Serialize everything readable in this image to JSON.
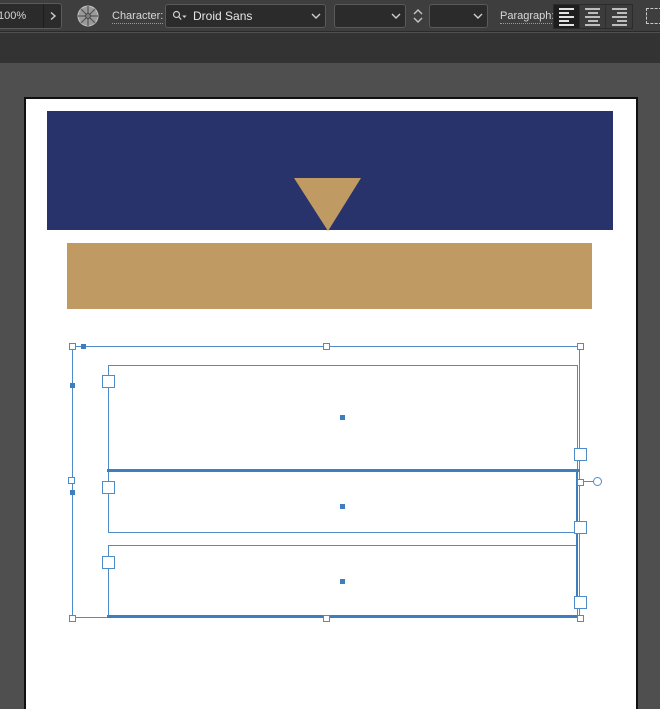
{
  "toolbar": {
    "zoom_level": "100%",
    "character_label": "Character:",
    "font_name": "Droid Sans",
    "font_style_value": "",
    "font_size_value": "",
    "paragraph_label": "Paragraph:",
    "align_options": [
      "align-left",
      "align-center",
      "align-right"
    ],
    "align_active": "align-left",
    "icons": {
      "zoom_expand": "chevron-right-icon",
      "workspace": "wheel-icon",
      "font_search": "search-icon",
      "dropdown": "chevron-down-icon",
      "stepper": "chevron-up-down-icons",
      "far_right": "dashed-selection-icon"
    }
  },
  "canvas": {
    "objects": [
      "navy-header-rectangle",
      "tan-down-triangle",
      "tan-bar-rectangle"
    ],
    "selected_text_frames": 3
  },
  "colors": {
    "navy": "#29336B",
    "tan": "#BF9B63",
    "selection_blue": "#4E8BC8",
    "selection_thick": "#3D7EBF",
    "toolbar_bg": "#3E3E3E",
    "band_bg": "#333333",
    "pasteboard": "#4F4F4F",
    "canvas": "#FFFFFF"
  }
}
